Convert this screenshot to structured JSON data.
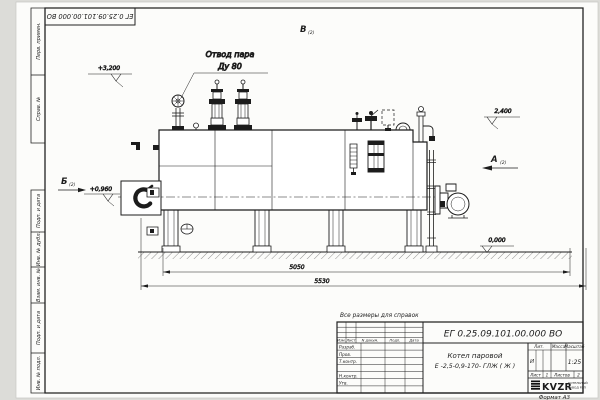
{
  "frame": {
    "corner_stamp": "ЕГ 0.25.09.101.00.000  ВО",
    "format_label": "Формат А3",
    "margin_labels": [
      "Перв. примен.",
      "Справ. №",
      "Подп. и дата",
      "Инв. № дубл.",
      "Взам. инв. №",
      "Подп. и дата",
      "Инв. № подл."
    ]
  },
  "drawing": {
    "callout_line1": "Отвод пара",
    "callout_line2": "Ду 80",
    "view_b": "Б",
    "view_b_ref": "(2)",
    "view_v": "В",
    "view_v_ref": "(2)",
    "view_a": "А",
    "view_a_ref": "(2)",
    "elev_top": "+3,200",
    "elev_drum": "2,400",
    "elev_burner": "+0,960",
    "elev_ground": "0,000",
    "dim_inner": "5050",
    "dim_outer": "5530",
    "note": "Все размеры для справок"
  },
  "title_block": {
    "doc_number": "ЕГ 0.25.09.101.00.000  ВО",
    "product_line1": "Котел паровой",
    "product_line2": "Е -2,5-0,9-170- ГЛЖ ( Ж )",
    "col_izm": "Изм.",
    "col_list": "Лист",
    "col_doc": "N докум.",
    "col_sign": "Подп.",
    "col_date": "Дата",
    "role_dev": "Разраб.",
    "role_check": "Пров.",
    "role_tcontr": "Т.контр.",
    "role_ncontr": "Н.контр.",
    "role_approve": "Утв.",
    "lit_header": "Лит.",
    "mass_header": "Масса",
    "scale_header": "Масштаб",
    "lit_value": "И",
    "scale_value": "1:25",
    "sheet_header": "Лист",
    "sheet_value": "1",
    "sheets_header": "Листов",
    "sheets_value": "2",
    "logo_text": "KVZR",
    "logo_sub1": "КОТЕЛЬНЫЙ",
    "logo_sub2": "ЗАВОД РЭП"
  }
}
